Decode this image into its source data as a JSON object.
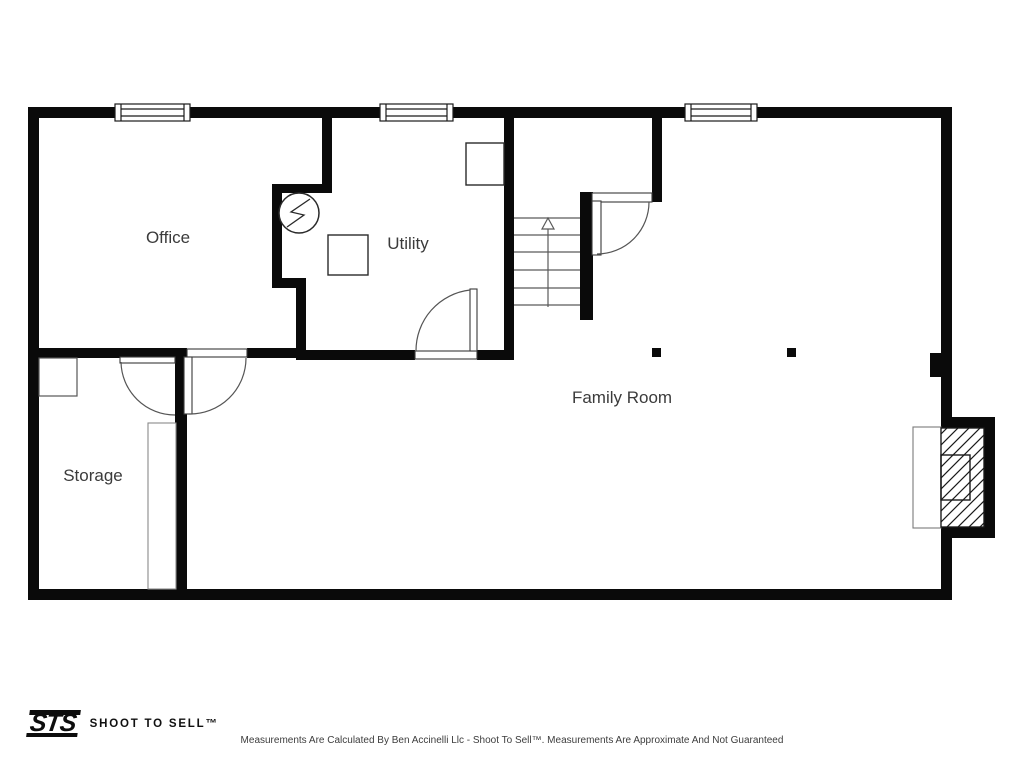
{
  "branding": {
    "logo_text": "STS",
    "brand_name": "SHOOT TO SELL™"
  },
  "footer": {
    "disclaimer": "Measurements Are Calculated By Ben Accinelli Llc - Shoot To Sell™. Measurements Are Approximate And Not Guaranteed"
  },
  "floor_plan": {
    "rooms": [
      {
        "name": "Office"
      },
      {
        "name": "Utility"
      },
      {
        "name": "Family Room"
      },
      {
        "name": "Storage"
      }
    ],
    "stairs": {
      "direction": "up",
      "treads": 6
    },
    "fixtures": [
      "water-heater",
      "furnace",
      "appliance",
      "fireplace",
      "hearth",
      "support-posts"
    ],
    "windows": 3,
    "doors": 4,
    "colors": {
      "walls": "#0a0a0a",
      "thin_lines": "#555555",
      "label_text": "#3b3b3b"
    }
  }
}
